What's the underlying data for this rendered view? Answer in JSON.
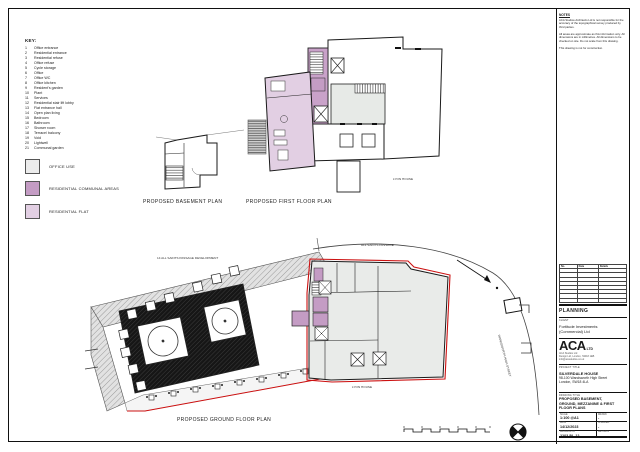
{
  "sheet": {
    "key": {
      "title": "KEY:",
      "items": [
        [
          "1",
          "Office entrance"
        ],
        [
          "2",
          "Residential entrance"
        ],
        [
          "3",
          "Residential refuse"
        ],
        [
          "4",
          "Office refuse"
        ],
        [
          "5",
          "Cycle storage"
        ],
        [
          "6",
          "Office"
        ],
        [
          "7",
          "Office WC"
        ],
        [
          "8",
          "Office kitchen"
        ],
        [
          "9",
          "Resident's garden"
        ],
        [
          "10",
          "Plant"
        ],
        [
          "11",
          "Services"
        ],
        [
          "12",
          "Residential stair lift lobby"
        ],
        [
          "13",
          "Flat entrance hall"
        ],
        [
          "14",
          "Open plan living"
        ],
        [
          "15",
          "Bedroom"
        ],
        [
          "16",
          "Bathroom"
        ],
        [
          "17",
          "Shower room"
        ],
        [
          "18",
          "Terrace/ balcony"
        ],
        [
          "19",
          "Void"
        ],
        [
          "20",
          "Lightwell"
        ],
        [
          "21",
          "Communal garden"
        ]
      ],
      "swatches": [
        {
          "label": "OFFICE USE",
          "color": "#ececec"
        },
        {
          "label": "RESIDENTIAL COMMUNAL AREAS",
          "color": "#c49cc4"
        },
        {
          "label": "RESIDENTIAL FLAT",
          "color": "#e2cfe3"
        }
      ]
    },
    "plans": {
      "basement_label": "PROPOSED BASEMENT PLAN",
      "first_label": "PROPOSED FIRST FLOOR PLAN",
      "ground_label": "PROPOSED GROUND FLOOR PLAN",
      "first_annotation": "LYON HOUSE",
      "ground_annotations": {
        "development": "14 ALL SAINTS PASSAGE DEVELOPMENT",
        "passage": "ALL SAINTS PASSAGE",
        "street": "WANDSWORTH HIGH STREET",
        "lyon": "LYON HOUSE"
      }
    },
    "titleblock": {
      "notes_title": "NOTES",
      "notes": [
        "ACA Studios Architects Ltd is not responsible for the accuracy of the topographical survey produced by third parties.",
        "All areas are approximate as this information only. All dimensions are in millimetres. All dimensions to be checked on site. Do not scale from this drawing.",
        "This drawing is not for construction."
      ],
      "revisions": {
        "headers": [
          "No.",
          "Date",
          "Details"
        ],
        "empty_rows": 8
      },
      "status": "PLANNING",
      "client_label": "CLIENT",
      "client_line1": "Fortitude Investments",
      "client_line2": "(Commercial) Ltd",
      "logo_main": "ACA",
      "logo_suffix": "LTD",
      "logo_lines": [
        "ACA Studios Ltd",
        "Design Ltd, London, SW18 1EB",
        "info@acastudios.co.uk"
      ],
      "project_label": "PROJECT TITLE",
      "project_lines": [
        "SILVERDALE HOUSE",
        "98-100 Wandsworth High Street",
        "London, SW18 4LA"
      ],
      "drawing_label": "DRAWING TITLE",
      "drawing_lines": [
        "PROPOSED BASEMENT,",
        "GROUND, MEZZANINE & FIRST",
        "FLOOR PLANS"
      ],
      "fields": [
        {
          "l": "SCALE",
          "v": "1:100 @A1",
          "l2": "DRAWN",
          "v2": "-"
        },
        {
          "l": "DATE",
          "v": "14/12/2023",
          "l2": "CHECKED",
          "v2": "-"
        },
        {
          "l": "DRAWING NO",
          "v": "2203-PL-12",
          "l2": "REVISION",
          "v2": "-"
        }
      ]
    }
  }
}
